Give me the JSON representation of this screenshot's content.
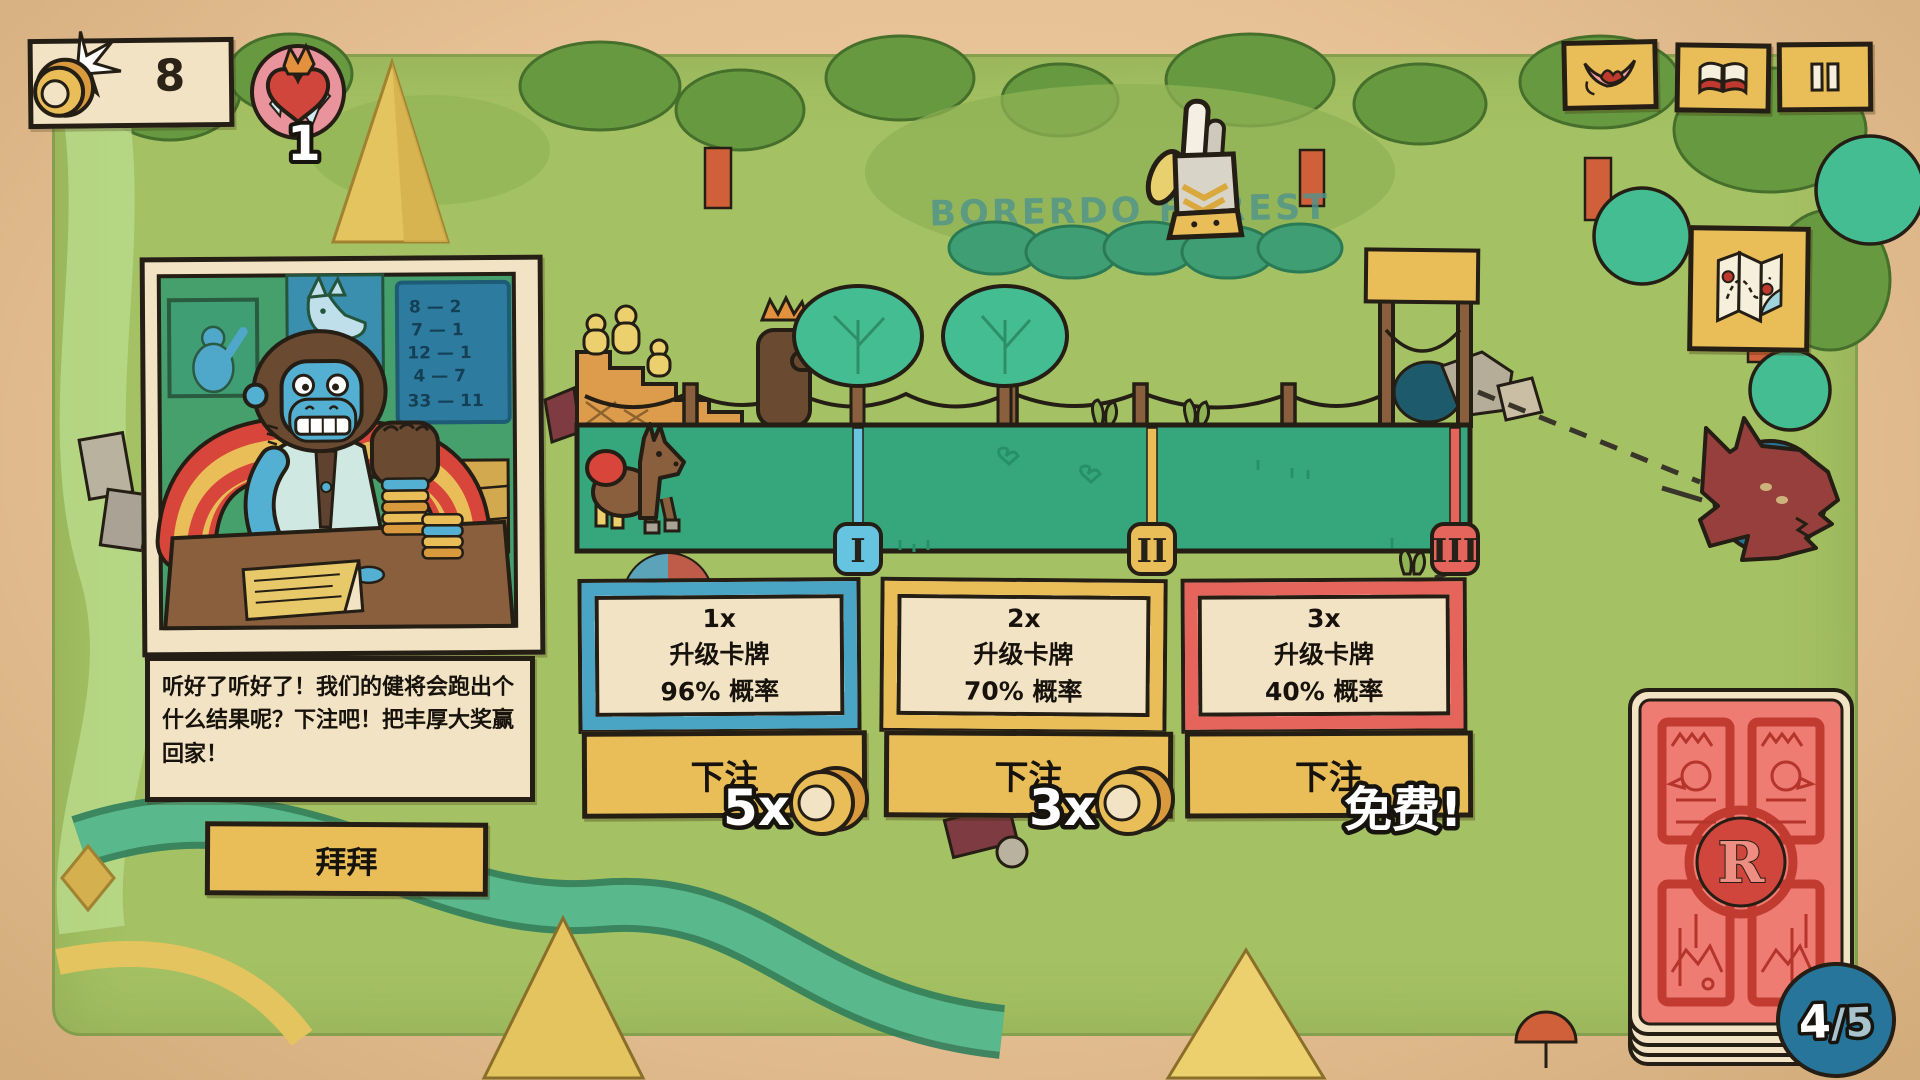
{
  "hud": {
    "coin_count": "8",
    "crown_count": "1"
  },
  "top_buttons": {
    "emote_icon": "mouth-icon",
    "journal_icon": "book-icon",
    "pause_icon": "pause-icon"
  },
  "map": {
    "region_label": "BORERDO FOREST",
    "map_button_icon": "map-icon"
  },
  "portrait": {
    "character": "gorilla-bookie",
    "blackboard_odds": [
      "8 — 2",
      "7 — 1",
      "12 — 1",
      "4 — 7",
      "33 — 11"
    ]
  },
  "dialogue": {
    "text": "听好了听好了！我们的健将会跑出个什么结果呢？下注吧！把丰厚大奖赢回家！",
    "dismiss_label": "拜拜"
  },
  "race": {
    "markers": [
      {
        "numeral": "I",
        "color": "#66c4e0"
      },
      {
        "numeral": "II",
        "color": "#e9be58"
      },
      {
        "numeral": "III",
        "color": "#e5655c"
      }
    ]
  },
  "bets": [
    {
      "multiplier": "1x",
      "reward": "升级卡牌",
      "chance": "96% 概率",
      "button_label": "下注",
      "cost": "5x",
      "accent": "#4aa4c4"
    },
    {
      "multiplier": "2x",
      "reward": "升级卡牌",
      "chance": "70% 概率",
      "button_label": "下注",
      "cost": "3x",
      "accent": "#e9be58"
    },
    {
      "multiplier": "3x",
      "reward": "升级卡牌",
      "chance": "40% 概率",
      "button_label": "下注",
      "cost": "免费!",
      "accent": "#e5655c"
    }
  ],
  "deck": {
    "emblem": "R",
    "count_current": "4",
    "count_rest": "/5"
  }
}
